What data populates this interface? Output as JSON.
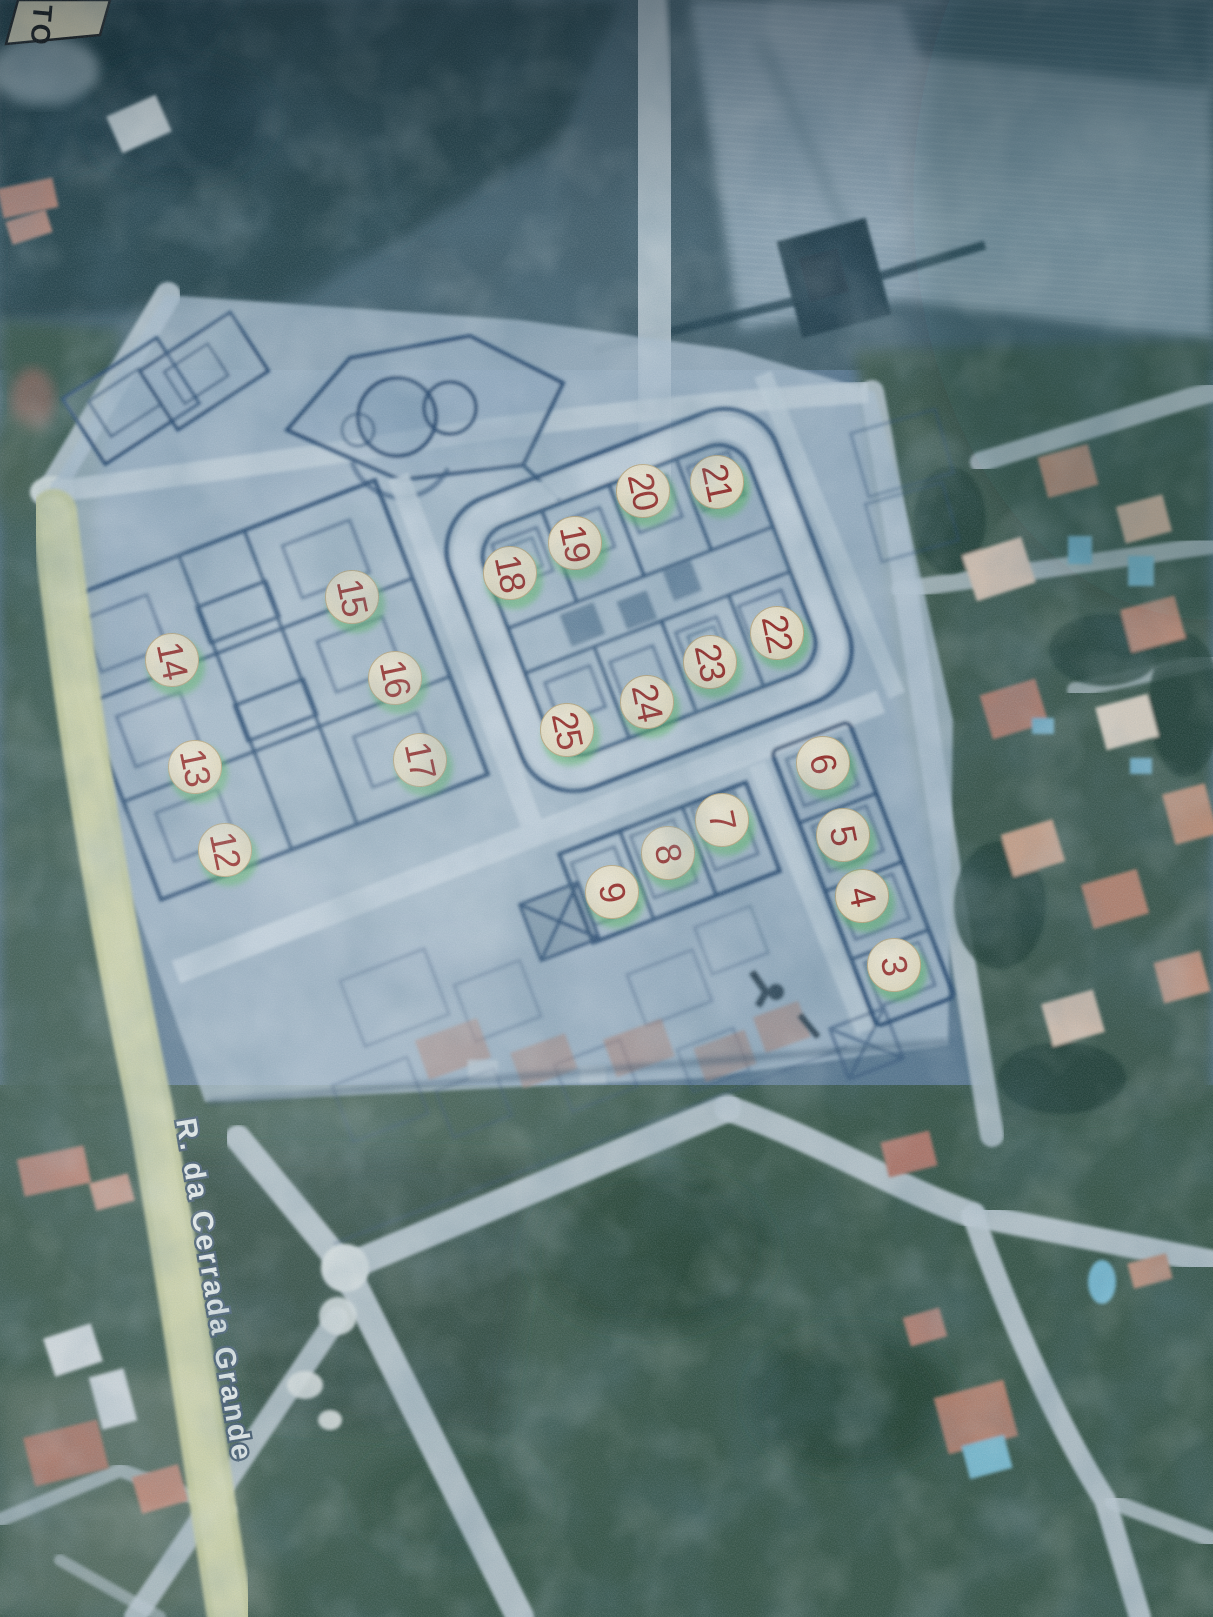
{
  "map_photo": {
    "street_label": "R. da Cerrada Grande",
    "corner_label": "TO",
    "marker_style": {
      "fill": "#f3ead0",
      "number_color": "#9e2a23"
    },
    "lot_markers": [
      {
        "label": "3",
        "x": 894,
        "y": 965
      },
      {
        "label": "4",
        "x": 862,
        "y": 896
      },
      {
        "label": "5",
        "x": 843,
        "y": 835
      },
      {
        "label": "6",
        "x": 823,
        "y": 763
      },
      {
        "label": "7",
        "x": 722,
        "y": 820
      },
      {
        "label": "8",
        "x": 668,
        "y": 853
      },
      {
        "label": "9",
        "x": 612,
        "y": 892
      },
      {
        "label": "12",
        "x": 225,
        "y": 850
      },
      {
        "label": "13",
        "x": 195,
        "y": 767
      },
      {
        "label": "14",
        "x": 172,
        "y": 660
      },
      {
        "label": "15",
        "x": 352,
        "y": 597
      },
      {
        "label": "16",
        "x": 395,
        "y": 678
      },
      {
        "label": "17",
        "x": 420,
        "y": 760
      },
      {
        "label": "18",
        "x": 510,
        "y": 573
      },
      {
        "label": "19",
        "x": 575,
        "y": 543
      },
      {
        "label": "20",
        "x": 643,
        "y": 491
      },
      {
        "label": "21",
        "x": 717,
        "y": 482
      },
      {
        "label": "22",
        "x": 777,
        "y": 633
      },
      {
        "label": "23",
        "x": 710,
        "y": 662
      },
      {
        "label": "24",
        "x": 647,
        "y": 702
      },
      {
        "label": "25",
        "x": 567,
        "y": 730
      }
    ]
  }
}
